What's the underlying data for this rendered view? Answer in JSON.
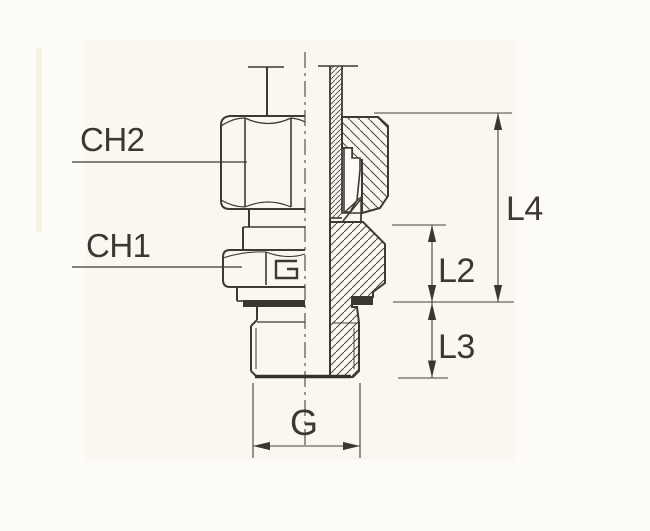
{
  "meta": {
    "type": "technical-drawing",
    "description": "Half-section engineering drawing of a male stud tube fitting (compression nut, ferrule, hex body, threaded stud) with dimension callouts"
  },
  "colors": {
    "paper": "#fcfbf8",
    "paper_tint": "#f6f0e2",
    "line": "#3c3a33",
    "thin_line": "#45423a",
    "label_text": "#3b3831",
    "seal_fill": "#3a372e"
  },
  "labels": {
    "ch2": "CH2",
    "ch1": "CH1",
    "l4": "L4",
    "l2": "L2",
    "l3": "L3",
    "g": "G"
  }
}
